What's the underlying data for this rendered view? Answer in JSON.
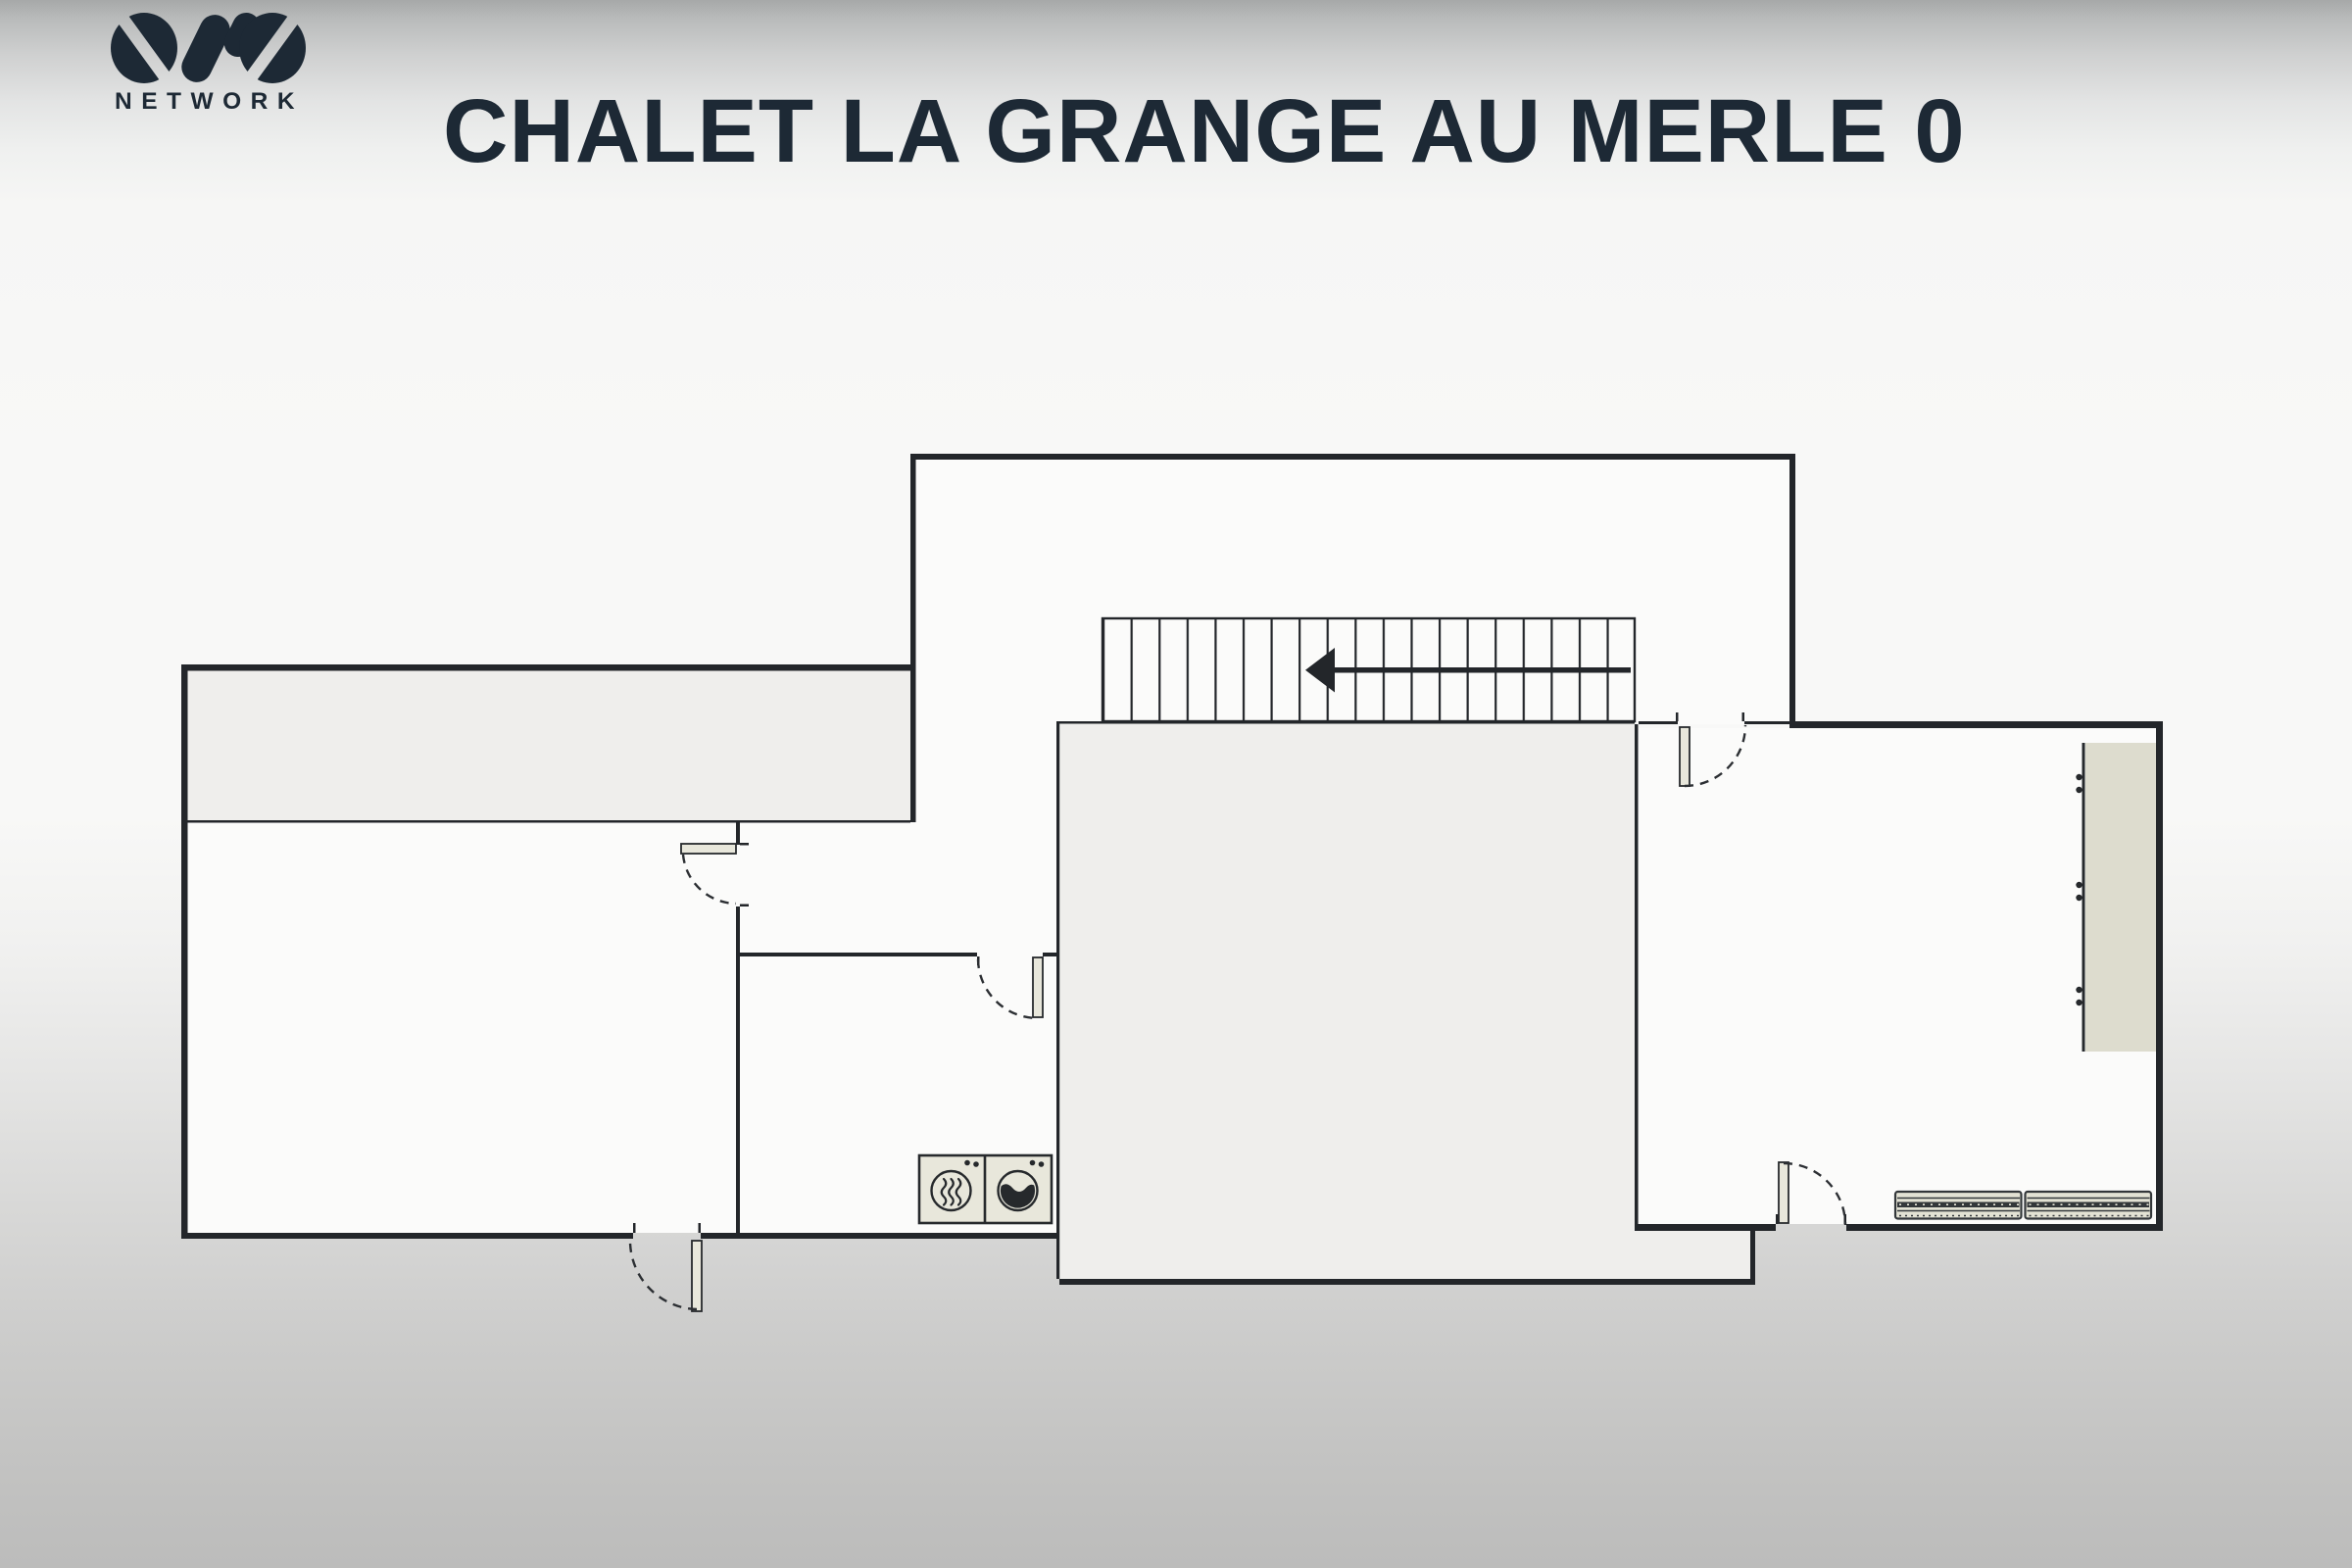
{
  "header": {
    "logo": {
      "name": "OVO Network logo",
      "subtext": "NETWORK"
    },
    "title": "CHALET LA GRANGE AU MERLE 0"
  },
  "plan": {
    "rooms": [
      "top-room",
      "left-room",
      "vestibule",
      "laundry-room",
      "stairwell-room",
      "right-room"
    ],
    "features": [
      "terrace-strip",
      "staircase",
      "stair-direction-arrow"
    ],
    "door_count": 5,
    "furniture_icons": [
      "dryer-icon",
      "washer-icon",
      "wardrobe",
      "bench",
      "bench"
    ]
  },
  "colors": {
    "title": "#1d2935",
    "wall": "#23262a",
    "line": "#2c2f33",
    "room": "#fbfbfa",
    "shaded": "#efeeec",
    "leaf": "#e8e7db",
    "furniture": "#e3e2d4",
    "wardrobe": "#dddcce",
    "icon": "#26292c"
  }
}
